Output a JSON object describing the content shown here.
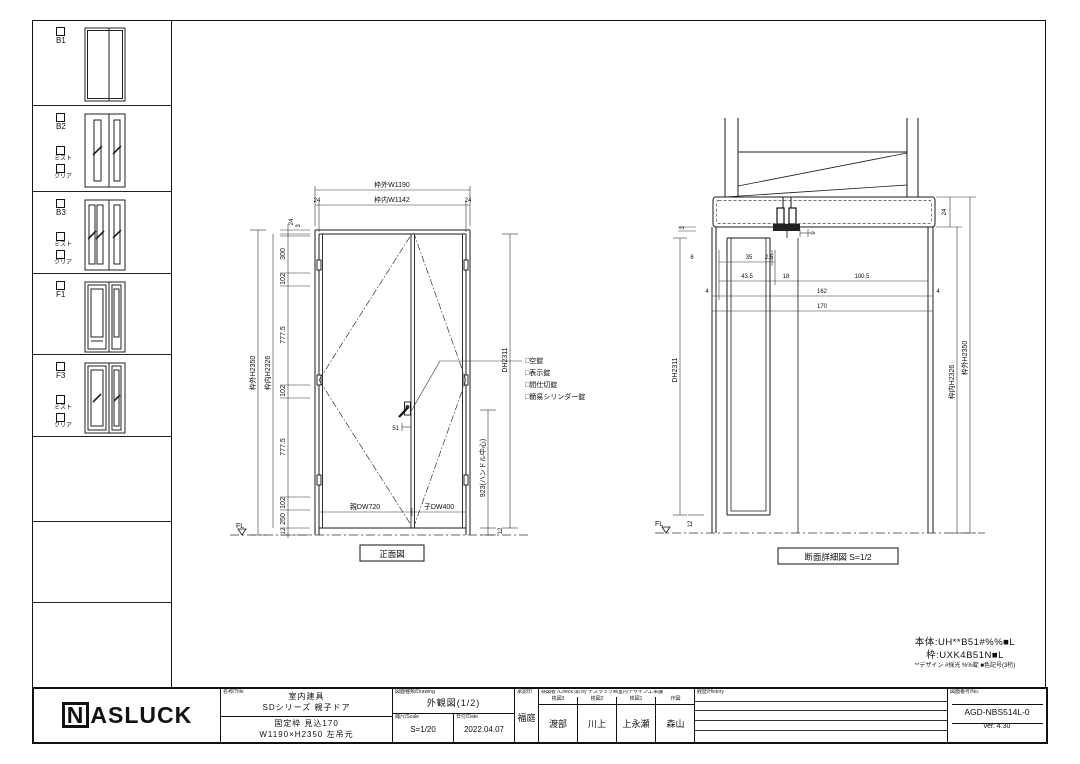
{
  "notes": {
    "body": "本体:UH**B51#%%■L",
    "frame": "枠:UXK4B51N■L",
    "legend": "**デザイン #採光 %%錠 ■色記号(3桁)"
  },
  "sidebar": {
    "variants": [
      {
        "id": "B1"
      },
      {
        "id": "B2",
        "mist": "ミスト",
        "clear": "クリア"
      },
      {
        "id": "B3",
        "mist": "ミスト",
        "clear": "クリア"
      },
      {
        "id": "F1"
      },
      {
        "id": "F3",
        "mist": "ミスト",
        "clear": "クリア"
      }
    ]
  },
  "front_view": {
    "title": "正面図",
    "w_outer": "枠外W1190",
    "w_inner": "枠内W1142",
    "d24": "24",
    "d3": "3",
    "h_outer": "枠外H2350",
    "h_inner": "枠内H2326",
    "c300": "300",
    "c102": "102",
    "c777": "777.5",
    "c250": "250",
    "c12": "12",
    "dh": "DH2311",
    "handle_center": "923(ハンドル中心)",
    "d51": "51",
    "parent_w": "親DW720",
    "child_w": "子DW400",
    "fl": "FL",
    "lock1": "□空錠",
    "lock2": "□表示錠",
    "lock3": "□間仕切錠",
    "lock4": "□簡易シリンダー錠"
  },
  "section_view": {
    "title": "断面詳細図 S=1/2",
    "d3": "3",
    "d9": "9",
    "d6": "6",
    "d35": "35",
    "d2_5": "2.5",
    "d43_5": "43.5",
    "d18": "18",
    "d100_5": "100.5",
    "d4": "4",
    "d162": "162",
    "d170": "170",
    "d24": "24",
    "d12": "12",
    "h_outer": "枠外H2350",
    "h_inner": "枠内H2326",
    "dh": "DH2311",
    "fl": "FL"
  },
  "title_block": {
    "logo_n": "N",
    "logo_rest": "ASLUCK",
    "name_label": "名称/Title",
    "name_line1": "室内建具",
    "name_line2": "SDシリーズ 親子ドア",
    "spec_line1": "固定枠 見込170",
    "spec_line2": "W1190×H2350 左吊元",
    "drawing_label": "図面種類/Drawing",
    "drawing_name": "外観図(1/2)",
    "scale_label": "縮尺/Scale",
    "scale_value": "S=1/20",
    "date_label": "日付/Date",
    "date_value": "2022.04.07",
    "approval_label": "承認印",
    "approval_name": "福庭",
    "check_label": "検図者 /Check up by ナスラック㈱室内デザイン工事課",
    "check_roles": [
      "検図3",
      "検図2",
      "検図1",
      "作図"
    ],
    "checkers": [
      "渡部",
      "川上",
      "上永瀬",
      "森山"
    ],
    "history_label": "経歴/History",
    "number_label": "図面番号/No.",
    "number": "AGD-NBS514L-0",
    "version": "ver. 4.30"
  }
}
